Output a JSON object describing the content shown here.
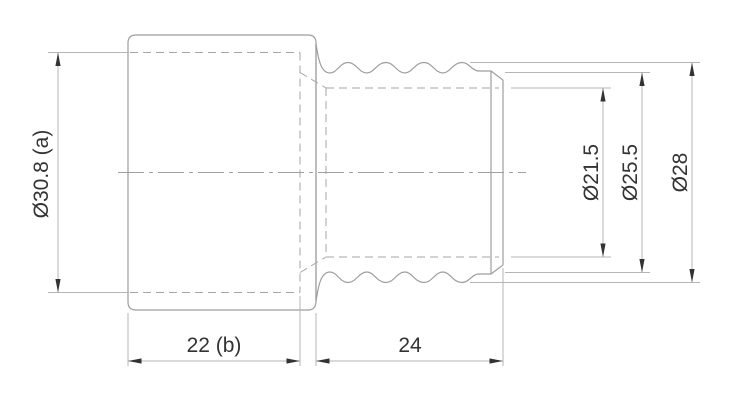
{
  "drawing": {
    "kind": "technical-drawing-2d-section-view",
    "labels": {
      "dia_socket_bore": "Ø30.8 (a)",
      "len_socket_depth": "22 (b)",
      "len_spigot": "24",
      "dia_bore": "Ø21.5",
      "dia_root": "Ø25.5",
      "dia_crest": "Ø28"
    },
    "colors": {
      "background": "#ffffff",
      "geometry_line": "#9e9e9e",
      "hidden_line": "#a6a6a6",
      "dimension_line": "#b5b5b5",
      "text": "#333333",
      "arrow": "#333333"
    }
  }
}
